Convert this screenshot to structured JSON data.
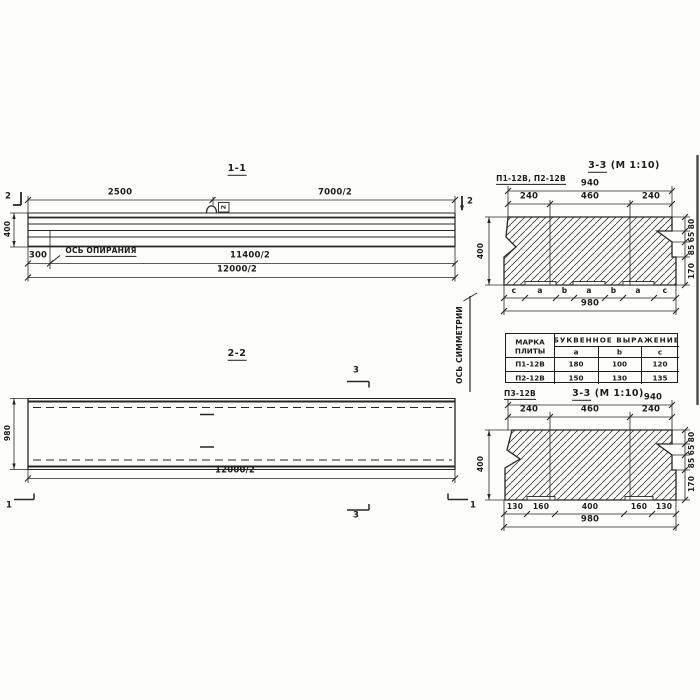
{
  "s11": {
    "title": "1-1",
    "dim_left": "2500",
    "dim_right": "7000/2",
    "height": "400",
    "offset": "300",
    "bearing_axis_label": "ОСЬ ОПИРАНИЯ",
    "dim_bearing": "11400/2",
    "dim_total": "12000/2",
    "section_marker": "2",
    "loop_tag": "2"
  },
  "s22": {
    "title": "2-2",
    "width": "980",
    "dim_total": "12000/2",
    "section_marker_3": "3",
    "section_marker_1": "1"
  },
  "symmetry_axis_label": "ОСЬ СИММЕТРИИ",
  "s33a": {
    "label": "П1-12В, П2-12В",
    "title": "3-3",
    "scale": "(М 1:10)",
    "top_total": "940",
    "top_dims": [
      "240",
      "460",
      "240"
    ],
    "height": "400",
    "right_dims": [
      "80",
      "65",
      "85",
      "170"
    ],
    "bottom_letters": [
      "c",
      "a",
      "b",
      "a",
      "b",
      "a",
      "c"
    ],
    "bottom_total": "980"
  },
  "s33b": {
    "label": "П3-12В",
    "title": "3-3",
    "scale": "(М 1:10)",
    "top_total": "940",
    "top_dims": [
      "240",
      "460",
      "240"
    ],
    "height": "400",
    "right_dims": [
      "80",
      "65",
      "85",
      "170"
    ],
    "bottom_dims": [
      "130",
      "160",
      "400",
      "160",
      "130"
    ],
    "bottom_total": "980"
  },
  "table": {
    "header_mark_1": "МАРКА",
    "header_mark_2": "ПЛИТЫ",
    "header_group": "БУКВЕННОЕ ВЫРАЖЕНИЕ",
    "columns": [
      "a",
      "b",
      "c"
    ],
    "rows": [
      {
        "mark": "П1-12В",
        "a": "180",
        "b": "100",
        "c": "120"
      },
      {
        "mark": "П2-12В",
        "a": "150",
        "b": "130",
        "c": "135"
      }
    ]
  }
}
